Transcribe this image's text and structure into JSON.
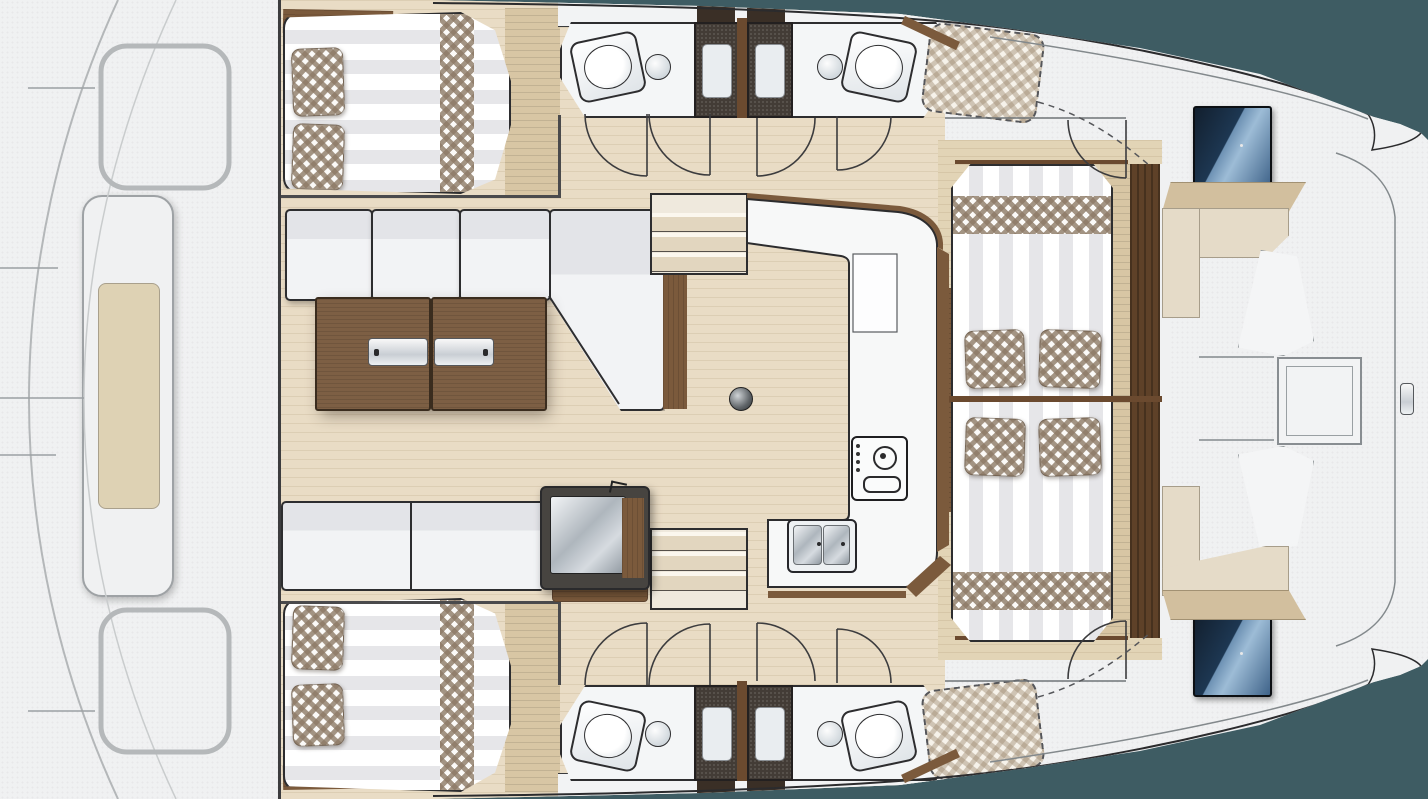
{
  "meta": {
    "kind": "floor-plan",
    "subject": "catamaran interior deck plan, top view, bow left / stern right"
  },
  "palette": {
    "bg": "#3E5C63",
    "hull": "#F0F1F2",
    "line": "#2D2D2F",
    "lightLine": "#9BA0A3",
    "floor": "#E9DCC5",
    "floorGrain": "rgba(164,140,105,0.18)",
    "floorAft": "#E2D4B6",
    "wood": "#7B5A3C",
    "woodDark": "#6B4A2F",
    "woodFloor": "#D8C6A4",
    "woodDoor": "#5E4128",
    "table": "#7D5F44",
    "cushion": "#F2F3F5",
    "cushionShade": "#E3E4E8",
    "mattress": "#FFFFFF",
    "mattressStripe": "#E6E6E9",
    "gingham": "#8D7A66",
    "stall": "#433C36",
    "tray": "#E9EDF0",
    "counter": "#F7F8F8",
    "screenDark": "#16283C",
    "screenLight": "#7FA3C4",
    "seatBeige": "#E5DBC8",
    "trimBeige": "#D2BF9E",
    "padBeige": "#DED2B4"
  },
  "areas": [
    {
      "name": "foredeck",
      "features": [
        "bow sun pod",
        "trampoline lines",
        "molded seats"
      ]
    },
    {
      "name": "forward-cabin-top",
      "features": [
        "double berth",
        "checkered pillows",
        "blanket runner"
      ]
    },
    {
      "name": "forward-cabin-bottom",
      "features": [
        "double berth",
        "checkered pillows",
        "blanket runner"
      ]
    },
    {
      "name": "head-top-left",
      "features": [
        "toilet",
        "round sink",
        "shower stall"
      ]
    },
    {
      "name": "head-top-right",
      "features": [
        "toilet",
        "round sink",
        "shower stall"
      ]
    },
    {
      "name": "head-bottom-left",
      "features": [
        "toilet",
        "round sink",
        "shower stall"
      ]
    },
    {
      "name": "head-bottom-right",
      "features": [
        "toilet",
        "round sink",
        "shower stall"
      ]
    },
    {
      "name": "salon",
      "features": [
        "L-sofa",
        "folding table with chrome handles",
        "bench",
        "top-load fridge",
        "mast post",
        "companionway stairs x2"
      ]
    },
    {
      "name": "galley",
      "features": [
        "U-counter",
        "two-burner stove",
        "double sink"
      ]
    },
    {
      "name": "aft-cabin-top",
      "features": [
        "double berth"
      ]
    },
    {
      "name": "aft-cabin-bottom",
      "features": [
        "double berth"
      ]
    },
    {
      "name": "cockpit",
      "features": [
        "helm screens x2",
        "beige benches",
        "white backrests",
        "deck hatch",
        "transom steps"
      ]
    },
    {
      "name": "side-decks",
      "features": [
        "dashed optional sunpads x2"
      ]
    }
  ]
}
